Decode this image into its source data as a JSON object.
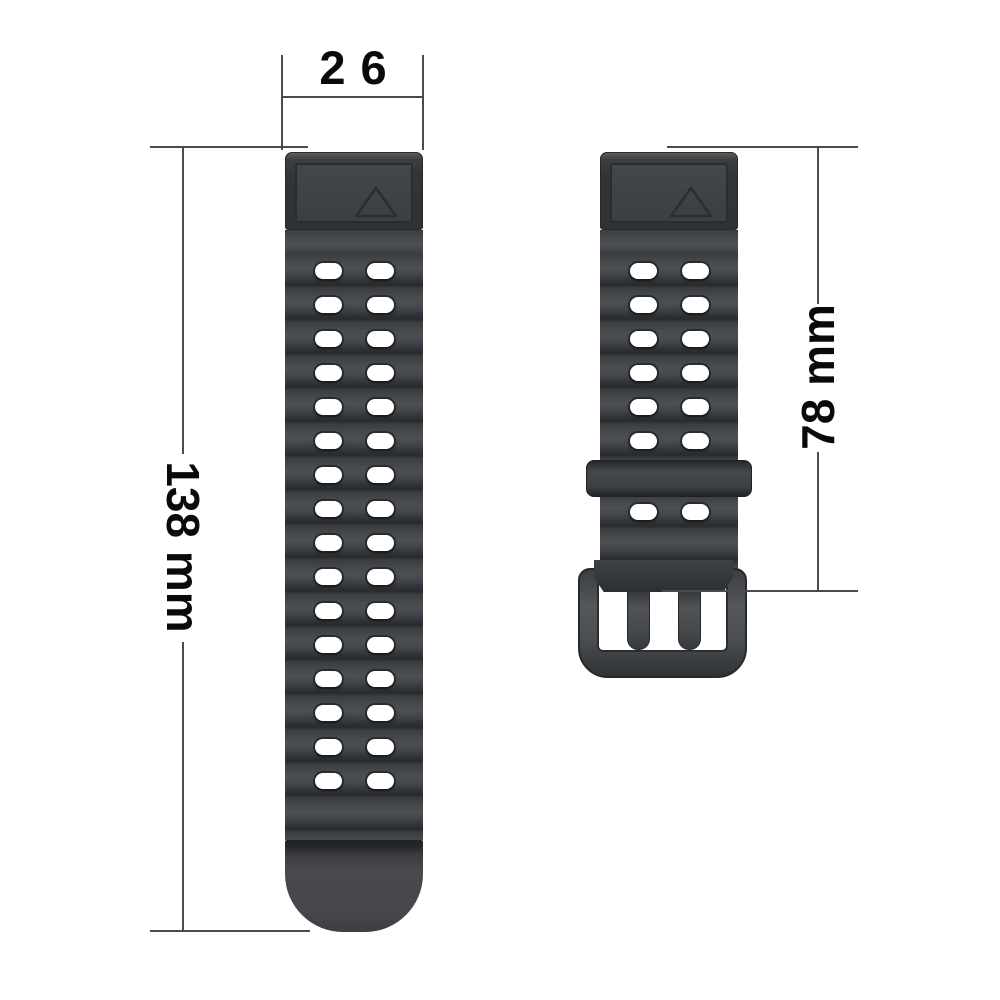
{
  "labels": {
    "width": "26",
    "long_strap_length": "138 mm",
    "short_strap_length": "78 mm"
  },
  "straps": {
    "long": {
      "hole_rows": 16,
      "holes_per_row": 2
    },
    "short": {
      "hole_rows_above_keeper": 6,
      "hole_rows_below_keeper": 1,
      "holes_per_row": 2,
      "prong_count": 2
    }
  },
  "icons": {
    "connector_mark": "triangle-up-outline"
  },
  "colors": {
    "background": "#ffffff",
    "strap_body": "#3c3f42",
    "strap_crest": "#4b4e51",
    "strap_valley": "#2a2d30",
    "connector": "#323538",
    "hardware": "#4a4d50",
    "hole": "#ffffff",
    "dimension_line": "#4b4b4b",
    "dimension_text": "#0a0a0a"
  }
}
